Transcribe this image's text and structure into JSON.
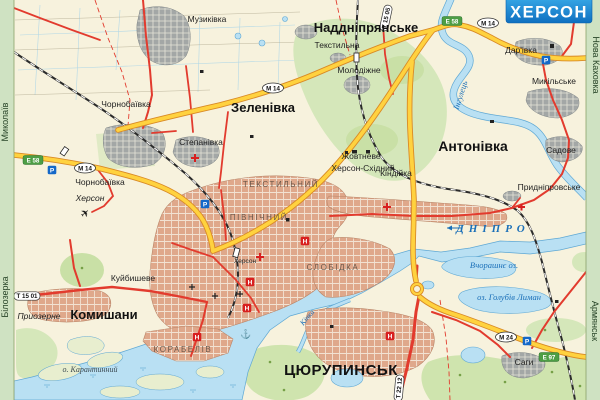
{
  "map_title": "ХЕРСОН",
  "cities": {
    "nadnipryanske": "Наддніпрянське",
    "zelenivka": "Зеленівка",
    "antonivka": "Антонівка",
    "komyshany": "Комишани",
    "tsyurupynsk": "ЦЮРУПИНСЬК"
  },
  "towns": {
    "muzykivka": "Музиківка",
    "chornobaivka": "Чорнобаївка",
    "stepanivka": "Степанівка",
    "tekstylna": "Текстильна",
    "molodizhne": "Молодіжне",
    "zhovtneve": "Жовтневе",
    "kherson_skhidnyi": "Херсон-Східний",
    "kindiyka": "Кіндійка",
    "darivka": "Дар'івка",
    "mykilske": "Микільське",
    "sadove": "Садове",
    "prydniprovske": "Придніпровське",
    "kuibysheve": "Куйбишеве",
    "pryozerne": "Приозерне",
    "sahy": "Саги"
  },
  "districts": {
    "tekstylnyi": "ТЕКСТИЛЬНИЙ",
    "pivnichnyi": "ПІВНІЧНИЙ",
    "slobidka": "СЛОБІДКА",
    "korabeliv": "КОРАБЕЛІВ"
  },
  "hydro": {
    "dnipro": "ДНІПРО",
    "inhulets": "Інгулець",
    "kinka": "Кінка",
    "holubyi_lyman": "оз. Голубів Лиман",
    "vchorashnie": "Вчорашнє оз.",
    "karantynnyi": "о. Карантинний"
  },
  "edges": {
    "mykolaiv": "Миколаїв",
    "bilozerka": "Білозерка",
    "nova_kakhovka": "Нова Каховка",
    "armiansk": "Армянськ"
  },
  "road_badges": {
    "e58": "Е 58",
    "e97": "Е 97",
    "m14": "М 14",
    "m24": "М 24",
    "t1501": "Т 15 01",
    "t1505": "Т 15 05",
    "t2212": "Т 22 12"
  },
  "poi": {
    "parking": "Р",
    "hotel": "Н",
    "airport_glyph": "✈",
    "anchor_glyph": "⚓",
    "airport_name": "Херсон",
    "station_name": "Херсон"
  },
  "palette": {
    "land": "#f7f2dd",
    "water": "#b9e0f3",
    "water_edge": "#5fa8d4",
    "green": "#d5e7ba",
    "urban": "#dfa88b",
    "village_gray": "#a3a7a6",
    "highway_fill": "#ffd23f",
    "highway_casing": "#d98a26",
    "main_road_red": "#e23b2e",
    "rail_black": "#2b2b2b",
    "badge_green": "#4d9e45",
    "parking_blue": "#1468c8",
    "hotel_red": "#d81f1f",
    "title_blue": "#1687d6"
  }
}
